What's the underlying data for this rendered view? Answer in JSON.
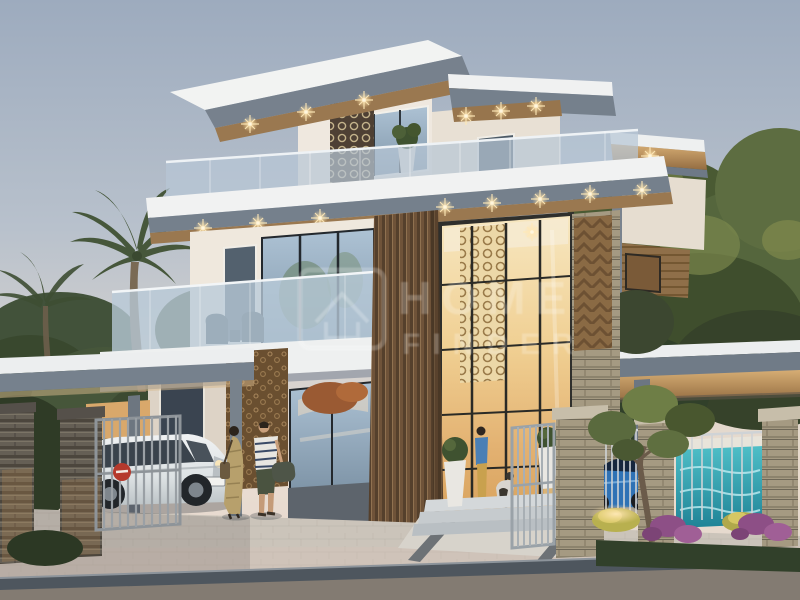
{
  "meta": {
    "type": "architectural-rendering",
    "description": "Dusk 3D render of a modern three-storey luxury villa with stacked cantilevered roofs, wood-slat feature column, lattice screens, glass balconies, gated driveway with white SUV, landscaped fence with blue sports car and turquoise water wall",
    "time_of_day": "dusk"
  },
  "watermark": {
    "line1": "HOME",
    "line2": "FINDER"
  },
  "palette": {
    "sky_top": "#9dabbe",
    "sky_horizon": "#e9dcd1",
    "roof_white": "#eef0f0",
    "fascia_gray": "#75808c",
    "soffit_wood": "#9a7850",
    "wall_cream": "#efe8dd",
    "glass_cool": "#a9bfd2",
    "glass_warm": "#f0cf92",
    "wood_slat": "#6f5339",
    "stone_pier_tan": "#a59a82",
    "stone_pillar_dark": "#655f55",
    "foliage_dark": "#39482e",
    "foliage_light": "#6d7d45",
    "pool_teal": "#2aa2b2",
    "car_white": "#e9edee",
    "car_blue": "#2f72b5",
    "sign_red": "#b5392c",
    "paver_light": "#cbc4ba",
    "curb_gray": "#4e565e",
    "asphalt_gray": "#837b72",
    "flower_purple": "#8d4f86",
    "light_warm": "#ffdf9e",
    "watermark_white": "#ffffff"
  },
  "scene": {
    "building": {
      "storeys": 3,
      "features": [
        "cantilevered flat roofs with downlights",
        "roof terrace with glass balustrade",
        "mashrabiya lattice panels",
        "vertical wood-slat column",
        "double-height glazed entrance",
        "stone-clad column",
        "glass balcony with lounge chairs",
        "carved wood wall panel"
      ]
    },
    "site": [
      "left carport with flat canopy",
      "dark stone gate pillars",
      "open metal gates",
      "red sign on gate",
      "right pergola canopy",
      "stone fence piers with railings",
      "turquoise water wall",
      "ornamental tree",
      "purple flower beds",
      "uplit shrubs",
      "paver sidewalk",
      "asphalt road"
    ],
    "vehicles": [
      {
        "type": "white SUV",
        "location": "under left carport"
      },
      {
        "type": "blue sports car",
        "location": "behind right fence"
      }
    ],
    "people": [
      {
        "description": "couple walking past the entrance carrying bags"
      },
      {
        "description": "woman with small dog inside the lit entrance"
      }
    ],
    "vegetation": [
      "palm trees on the left",
      "large broadleaf trees on the right",
      "topiary balls in white planters"
    ]
  }
}
